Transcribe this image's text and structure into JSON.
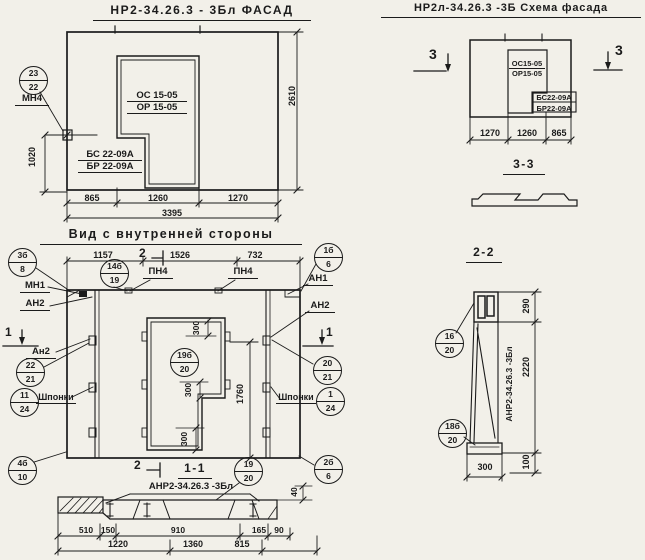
{
  "facade": {
    "title": "НР2-34.26.3 - 3Бл ФАСАД",
    "opening_mark": [
      "ОС 15-05",
      "ОР 15-05"
    ],
    "panel_mark": [
      "БС 22-09А",
      "БР 22-09А"
    ],
    "callout_23_22": {
      "top": "23",
      "bottom": "22"
    },
    "anchor_label": "МН4",
    "dim_height_left": "1020",
    "dim_height_right": "2610",
    "dims_bottom": [
      "865",
      "1260",
      "1270"
    ],
    "dim_total": "3395"
  },
  "schema": {
    "title": "НР2л-34.26.3 -3Б Схема фасада",
    "opening_mark": [
      "ОС15-05",
      "ОР15-05"
    ],
    "panel_mark": [
      "БС22-09А",
      "БР22-09А"
    ],
    "section_mark": "3",
    "dims_bottom": [
      "1270",
      "1260",
      "865"
    ],
    "section_title": "3-3"
  },
  "inner": {
    "title": "Вид с внутренней стороны",
    "dims_top": [
      "1157",
      "1526",
      "732"
    ],
    "section_mark_1": "1",
    "section_mark_2": "2",
    "labels": {
      "mn1": "МН1",
      "an1": "АН1",
      "an2_left": "АН2",
      "an2_right": "АН2",
      "an2_left2": "Ан2",
      "pn4": "ПН4",
      "shponki": "Шпонки"
    },
    "callouts": {
      "c3b8": {
        "top": "3б",
        "bottom": "8"
      },
      "c14b19": {
        "top": "14б",
        "bottom": "19"
      },
      "c1b6": {
        "top": "1б",
        "bottom": "6"
      },
      "c22_21": {
        "top": "22",
        "bottom": "21"
      },
      "c11_24": {
        "top": "11",
        "bottom": "24"
      },
      "c19b20": {
        "top": "19б",
        "bottom": "20"
      },
      "c20_21": {
        "top": "20",
        "bottom": "21"
      },
      "c1_24": {
        "top": "1",
        "bottom": "24"
      },
      "c4b10": {
        "top": "4б",
        "bottom": "10"
      },
      "c2b6": {
        "top": "2б",
        "bottom": "6"
      },
      "c19_20": {
        "top": "19",
        "bottom": "20"
      }
    },
    "dim_300": "300",
    "dim_1760": "1760",
    "section_1_1": {
      "title": "1-1",
      "label": "АНР2-34.26.3 -3Бл",
      "dims_row1": [
        "510",
        "150",
        "910",
        "165",
        "90"
      ],
      "dim_40": "40",
      "dims_row2": [
        "1220",
        "1360",
        "815"
      ]
    }
  },
  "section22": {
    "title": "2-2",
    "callout_16_20": {
      "top": "16",
      "bottom": "20"
    },
    "callout_18b20": {
      "top": "18б",
      "bottom": "20"
    },
    "dim_290": "290",
    "dim_2220": "2220",
    "dim_300": "300",
    "dim_100": "100",
    "vertical_label": "АНР2-34.26.3 -3Бл"
  }
}
